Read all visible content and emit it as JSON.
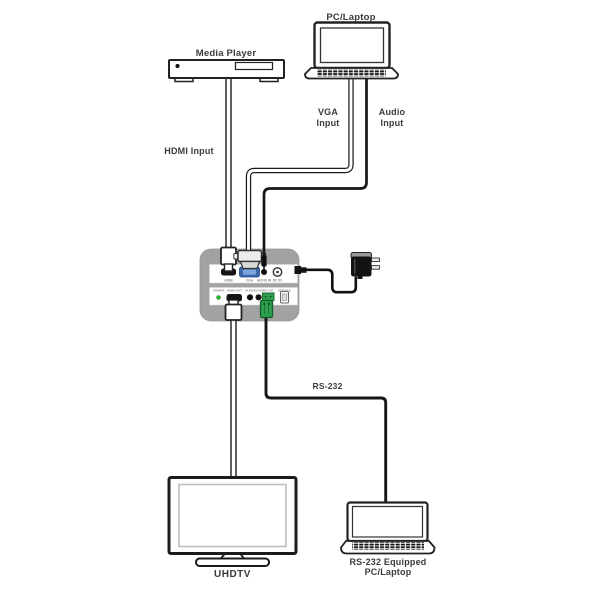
{
  "labels": {
    "media_player": "Media Player",
    "pc_laptop": "PC/Laptop",
    "hdmi_input": "HDMI Input",
    "vga_input": [
      "VGA",
      "Input"
    ],
    "audio_input": [
      "Audio",
      "Input"
    ],
    "rs232": "RS-232",
    "uhdtv": "UHDTV",
    "rs232_laptop": [
      "RS-232 Equipped",
      "PC/Laptop"
    ]
  },
  "device": {
    "front_panel_ports": [
      "HDMI",
      "VGA",
      "AUDIO IN",
      "DC 5V"
    ],
    "rear_panel_ports": [
      "POWER",
      "HDMI OUT",
      "AUDIO",
      "COAX",
      "RS-232",
      "SERVICE"
    ]
  },
  "colors": {
    "device_body": "#A2A2A2",
    "vga_port_blue": "#3B68AD",
    "phoenix_green": "#2E9E4F",
    "led_green": "#2DB52D",
    "cable_black": "#161616"
  }
}
